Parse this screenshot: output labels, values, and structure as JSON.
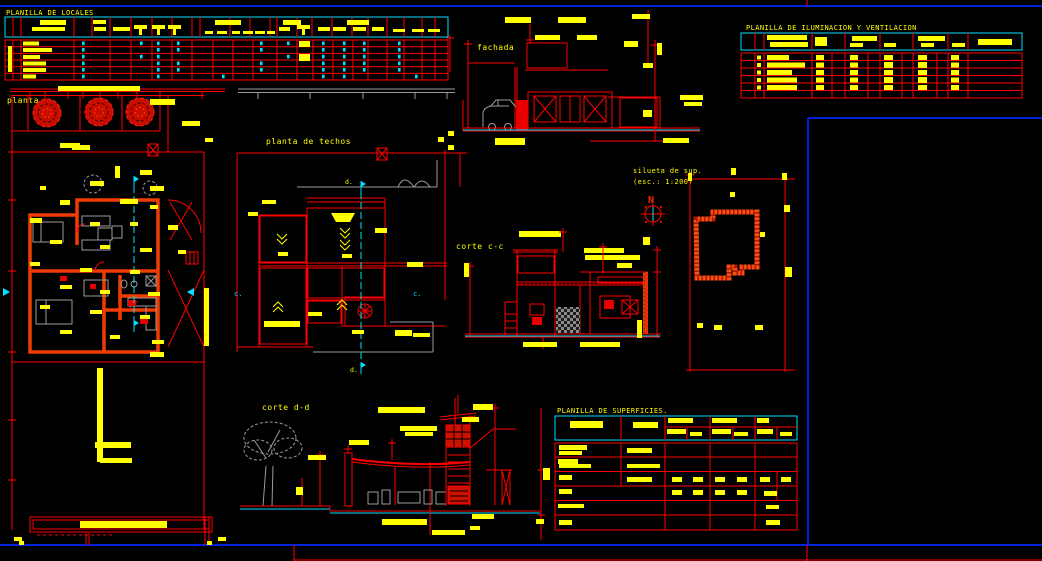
{
  "app": {
    "kind": "cad-drawing-sheet",
    "background": "#000000"
  },
  "palette": {
    "line_red": "#ff0000",
    "text_yellow": "#ffff00",
    "marker_cyan": "#00e0ff",
    "sheet_blue": "#0022dd",
    "aux_gray": "#9c9c9c",
    "wall_orange": "#f03c00"
  },
  "tables": {
    "locales": {
      "title": "PLANILLA DE LOCALES"
    },
    "iluminacion": {
      "title": "PLANILLA DE ILUMINACION Y VENTILACION"
    },
    "superficies": {
      "title": "PLANILLA DE SUPERFICIES."
    }
  },
  "drawings": {
    "planta": {
      "label": "planta"
    },
    "techos": {
      "label": "planta de techos"
    },
    "fachada": {
      "label": "fachada"
    },
    "corte_cc": {
      "label": "corte c-c"
    },
    "corte_dd": {
      "label": "corte d-d"
    },
    "silueta": {
      "label_line1": "silueta de sup.",
      "label_line2": "(esc.: 1:200)",
      "north_label": "N"
    }
  },
  "markers": {
    "section_c": "c.",
    "section_d": "d."
  }
}
